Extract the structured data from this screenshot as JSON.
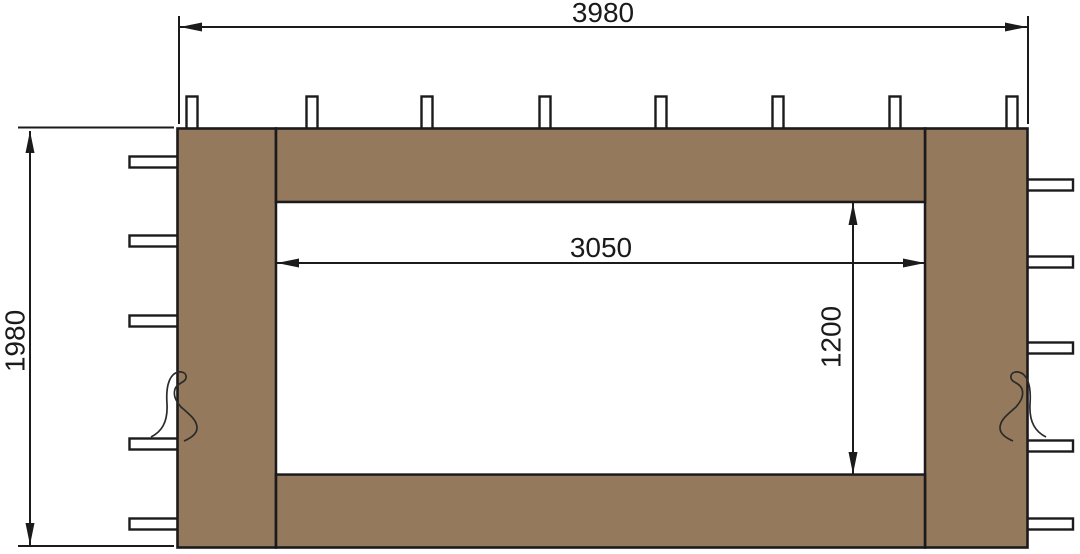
{
  "diagram": {
    "type": "dimensioned-technical-drawing",
    "subject": "gazebo-sidewall-panel-with-window-opening",
    "dimensions": {
      "outer_width": "3980",
      "outer_height": "1980",
      "inner_width": "3050",
      "inner_height": "1200"
    },
    "features": {
      "top_tab_count": 8,
      "left_tab_count": 5,
      "right_tab_count": 5,
      "tie_hook_count": 2
    },
    "colors": {
      "panel_fill": "#95795C",
      "outline": "#1B1B1B",
      "background": "#FFFFFF"
    }
  }
}
